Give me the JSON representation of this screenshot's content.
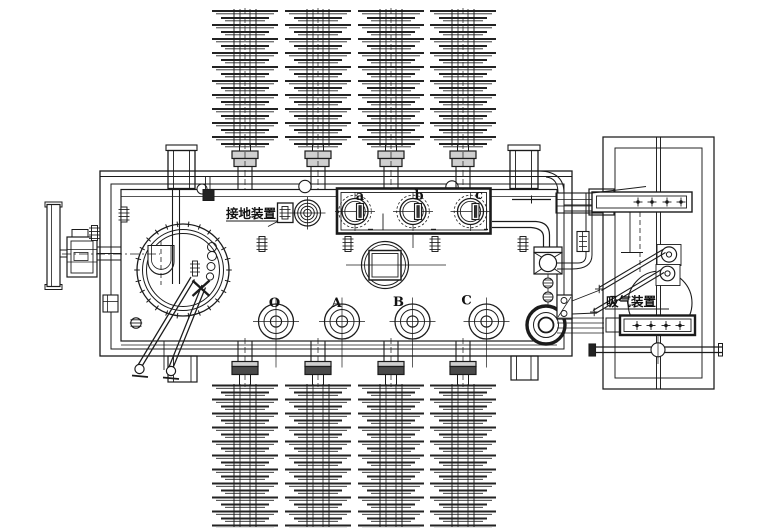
{
  "labels": {
    "grounding": "接地装置",
    "suction": "吸气装置",
    "top_bushings": [
      "a",
      "b",
      "c"
    ],
    "bottom_ports": [
      "O",
      "A",
      "B",
      "C"
    ]
  },
  "colors": {
    "line": "#1b1b1b",
    "fins": "#232323",
    "background": "#ffffff",
    "flange_dark": "#4a4a4a",
    "flange_mid": "#cfcfcf"
  },
  "structure": {
    "top_insulator_count": 4,
    "bottom_insulator_count": 4,
    "insulator_centers_x": [
      245,
      318,
      391,
      463
    ],
    "top_fin_rows": 20,
    "bottom_fin_rows": 21,
    "top_bushing_centers_x": [
      355,
      413,
      470.5
    ],
    "bottom_port_centers_x": [
      276,
      342,
      412.5,
      486.5
    ]
  }
}
